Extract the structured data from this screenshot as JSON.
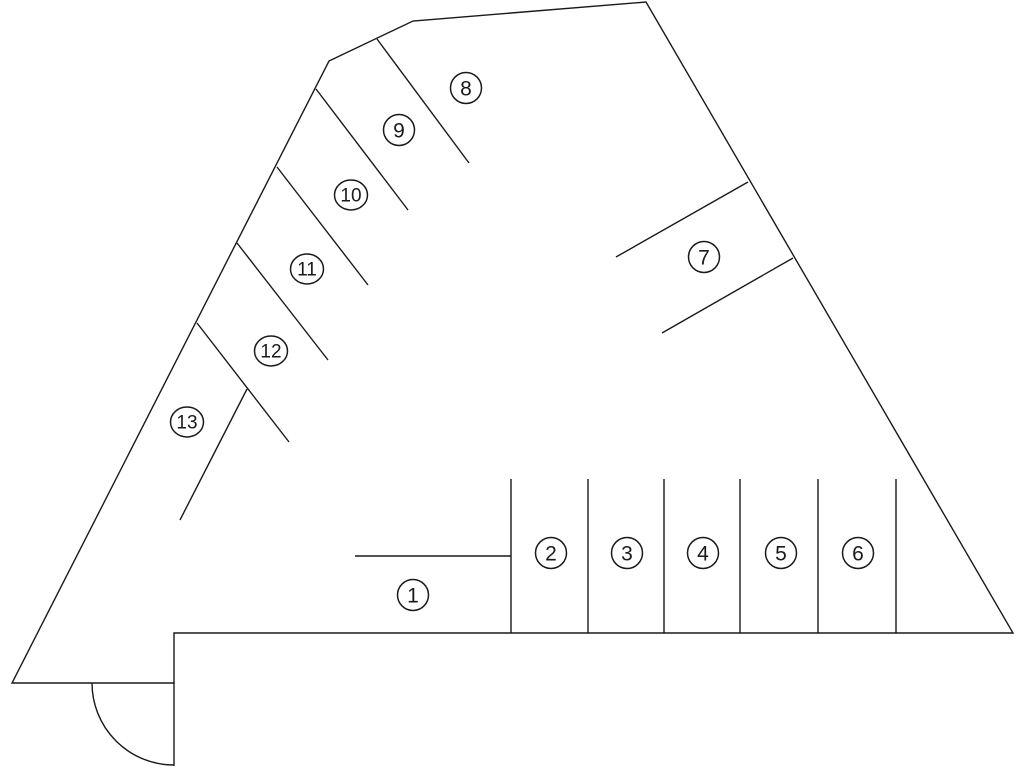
{
  "page": {
    "background_color": "#ffffff",
    "description": "parking-lot-floor-plan"
  },
  "diagram": {
    "stroke_color": "#1a1a1a",
    "stroke_width": 1.4,
    "circle_stroke_width": 1.5,
    "label_font_size_single": 21,
    "label_font_size_double": 19,
    "canvas": {
      "width": 1024,
      "height": 768
    },
    "outline": {
      "name": "lot-outline",
      "closed": true,
      "points": [
        [
          329,
          61
        ],
        [
          413,
          21
        ],
        [
          646,
          2
        ],
        [
          1013,
          633
        ],
        [
          174,
          633
        ],
        [
          174,
          683
        ],
        [
          12,
          683
        ]
      ]
    },
    "door": {
      "leaf": {
        "name": "door-leaf",
        "x1": 174,
        "y1": 683,
        "x2": 174,
        "y2": 766
      },
      "arc": {
        "name": "door-swing-arc",
        "cx": 174,
        "cy": 683,
        "r": 82
      }
    },
    "dividers": [
      {
        "name": "divider-space-8-9",
        "x1": 377,
        "y1": 39,
        "x2": 469,
        "y2": 163
      },
      {
        "name": "divider-space-9-10",
        "x1": 316,
        "y1": 89,
        "x2": 408,
        "y2": 210
      },
      {
        "name": "divider-space-10-11",
        "x1": 277,
        "y1": 167,
        "x2": 368,
        "y2": 285
      },
      {
        "name": "divider-space-11-12",
        "x1": 237,
        "y1": 243,
        "x2": 328,
        "y2": 360
      },
      {
        "name": "divider-space-12-13",
        "x1": 197,
        "y1": 323,
        "x2": 289,
        "y2": 442
      },
      {
        "name": "divider-space-13-end",
        "x1": 247,
        "y1": 389,
        "x2": 180,
        "y2": 520
      },
      {
        "name": "divider-space-7-upper",
        "x1": 748,
        "y1": 182,
        "x2": 616,
        "y2": 257
      },
      {
        "name": "divider-space-7-lower",
        "x1": 793,
        "y1": 258,
        "x2": 662,
        "y2": 333
      },
      {
        "name": "divider-space-1-top",
        "x1": 355,
        "y1": 556,
        "x2": 511,
        "y2": 556
      },
      {
        "name": "divider-space-1-2",
        "x1": 511,
        "y1": 479,
        "x2": 511,
        "y2": 633
      },
      {
        "name": "divider-space-2-3",
        "x1": 588,
        "y1": 479,
        "x2": 588,
        "y2": 633
      },
      {
        "name": "divider-space-3-4",
        "x1": 664,
        "y1": 479,
        "x2": 664,
        "y2": 633
      },
      {
        "name": "divider-space-4-5",
        "x1": 740,
        "y1": 479,
        "x2": 740,
        "y2": 633
      },
      {
        "name": "divider-space-5-6",
        "x1": 818,
        "y1": 479,
        "x2": 818,
        "y2": 633
      },
      {
        "name": "divider-space-6-end",
        "x1": 896,
        "y1": 479,
        "x2": 896,
        "y2": 633
      }
    ],
    "spaces": [
      {
        "label": "1",
        "cx": 413,
        "cy": 595
      },
      {
        "label": "2",
        "cx": 551,
        "cy": 553
      },
      {
        "label": "3",
        "cx": 627,
        "cy": 553
      },
      {
        "label": "4",
        "cx": 703,
        "cy": 553
      },
      {
        "label": "5",
        "cx": 781,
        "cy": 553
      },
      {
        "label": "6",
        "cx": 858,
        "cy": 553
      },
      {
        "label": "7",
        "cx": 704,
        "cy": 257
      },
      {
        "label": "8",
        "cx": 466,
        "cy": 88
      },
      {
        "label": "9",
        "cx": 399,
        "cy": 130
      },
      {
        "label": "10",
        "cx": 351,
        "cy": 195
      },
      {
        "label": "11",
        "cx": 307,
        "cy": 269
      },
      {
        "label": "12",
        "cx": 271,
        "cy": 351
      },
      {
        "label": "13",
        "cx": 187,
        "cy": 422
      }
    ],
    "circle_radius_single": 15.5,
    "circle_radius_double_x": 16.5,
    "circle_radius_double_y": 15
  }
}
